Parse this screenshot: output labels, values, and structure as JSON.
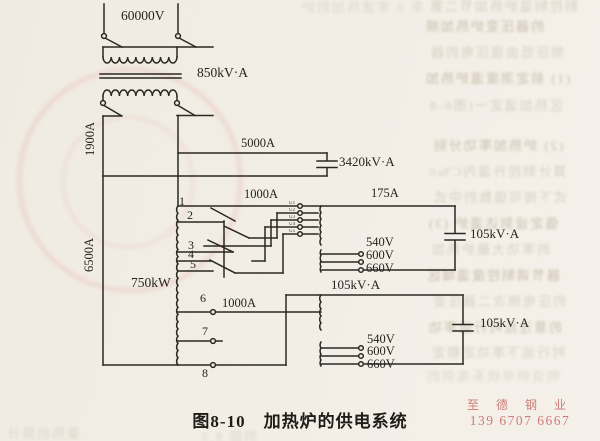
{
  "diagram": {
    "caption": "图8-10　加热炉的供电系统",
    "supply_voltage": "60000V",
    "main_transformer_rating": "850kV·A",
    "left_feeder_current": "1900A",
    "capacitor_branch_current": "5000A",
    "main_capacitor_rating": "3420kV·A",
    "left_bus_current": "6500A",
    "furnace_power": "750kW",
    "tap_numbers": [
      "1",
      "2",
      "3",
      "4",
      "5",
      "6",
      "7",
      "8"
    ],
    "upper": {
      "tap_line_current": "1000A",
      "primary_current": "175A",
      "capacitor_rating": "105kV·A",
      "secondary_voltages": [
        "540V",
        "600V",
        "660V"
      ],
      "winding_taps": [
        "U1",
        "U2",
        "U3",
        "U4",
        "U5"
      ]
    },
    "lower": {
      "tap_line_current": "1000A",
      "line_rating": "105kV·A",
      "capacitor_rating": "105kV·A",
      "secondary_voltages": [
        "540V",
        "600V",
        "660V"
      ]
    }
  },
  "watermark": {
    "name": "至 德 钢 业",
    "phone": "139 6707 6667",
    "color": "#c9736c"
  },
  "bleedthrough_rows": [
    "制控制温炉热加节二第",
    "率 8 率速热加的炉",
    "的器压变炉热加顺",
    "侧压低由值压电的器",
    "(1) 前定测度温炉热加",
    "区热加温定一(图8-8",
    "(2) 炉热加率功分别",
    "算计制控升温内C‰0",
    "式下按可值数的中式",
    "值定设到达温炉 (3)",
    "的率功大最炉热加",
    "器节调制控度温域区",
    "的压电侧次二器压变",
    "的意注应时行运率功",
    "时行运下率功定额定",
    "明说例举统系电供的",
    "量热的算计",
    "例题 8.3"
  ]
}
